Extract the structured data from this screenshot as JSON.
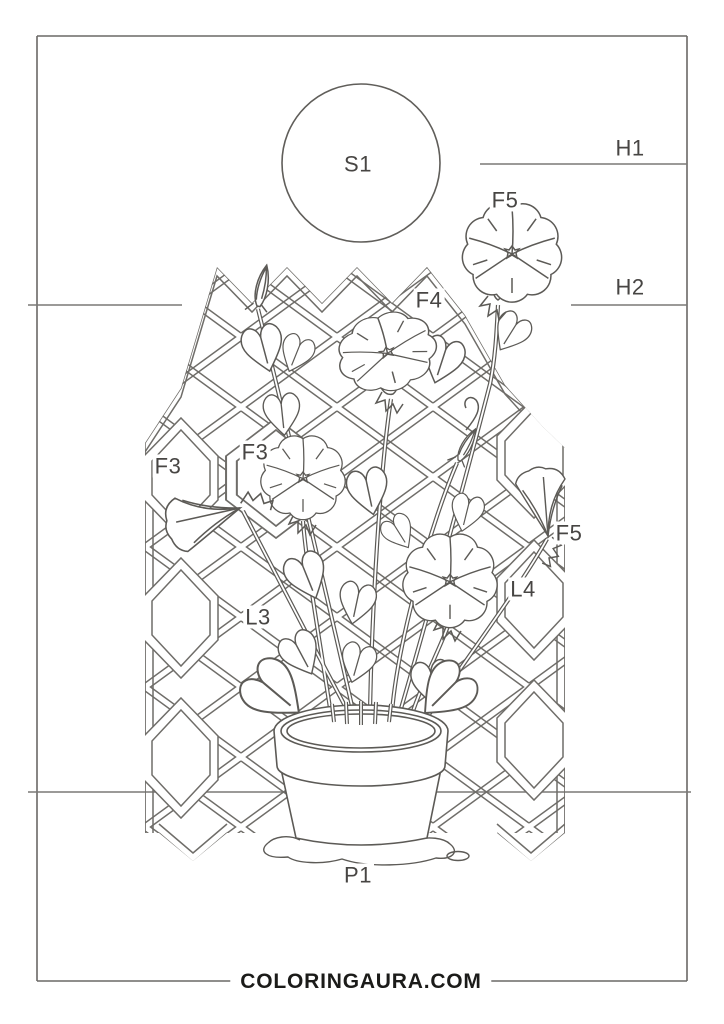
{
  "page": {
    "width": 724,
    "height": 1024,
    "background": "#ffffff"
  },
  "palette": {
    "art_line": "#5c5a56",
    "frame_line": "#6a6866",
    "label_text": "#474543",
    "footer_text": "#1b1b19"
  },
  "labels": [
    {
      "text": "S1"
    },
    {
      "text": "H1"
    },
    {
      "text": "F5"
    },
    {
      "text": "F4"
    },
    {
      "text": "H2"
    },
    {
      "text": "F3"
    },
    {
      "text": "F3"
    },
    {
      "text": "F5"
    },
    {
      "text": "L4"
    },
    {
      "text": "L3"
    },
    {
      "text": "P1"
    }
  ],
  "footer": {
    "site_text": "COLORINGAURA.COM"
  },
  "scene": {
    "parts": [
      "sun",
      "lattice-trellis",
      "morning-glory-vine",
      "heart-leaves",
      "flower-buds",
      "flower-pot",
      "water-puddle",
      "ground-line",
      "horizon-line-upper",
      "horizon-line-lower",
      "page-frame"
    ]
  }
}
